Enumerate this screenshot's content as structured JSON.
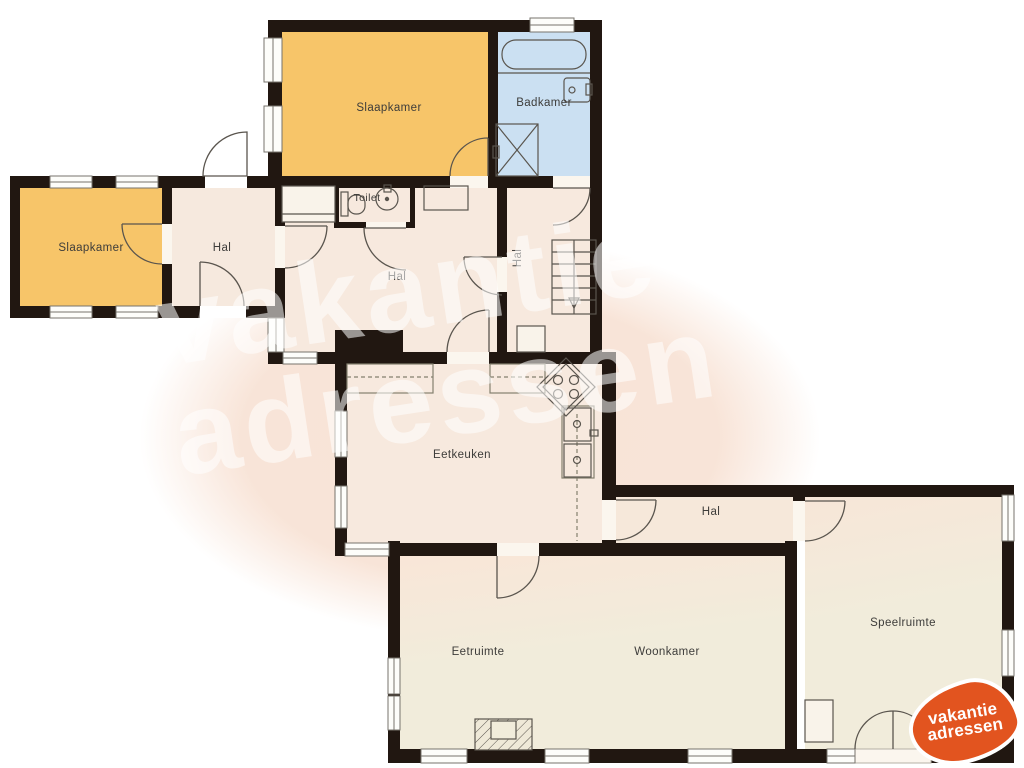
{
  "labels": {
    "slaapkamer_top": "Slaapkamer",
    "badkamer": "Badkamer",
    "toilet": "Toilet",
    "slaapkamer_left": "Slaapkamer",
    "hal_left": "Hal",
    "hal_center": "Hal",
    "hal_right": "Hal",
    "eetkeuken": "Eetkeuken",
    "hal_bottom": "Hal",
    "eetruimte": "Eetruimte",
    "woonkamer": "Woonkamer",
    "speelruimte": "Speelruimte"
  },
  "watermark": {
    "line1": "vakantie",
    "line2": "adressen"
  },
  "logo": {
    "line1": "vakantie",
    "line2": "adressen"
  },
  "colors": {
    "wall": "#211711",
    "bedroom_orange": "#f7c569",
    "bathroom_blue": "#cbe0f2",
    "hall_pink": "#f7e9de",
    "living_cream": "#f1ecdb",
    "background_blob": "#f8e3d6",
    "watermark_white": "rgba(255,255,255,0.55)",
    "logo_orange": "#e2541f",
    "label_text": "#3d3c3a"
  }
}
